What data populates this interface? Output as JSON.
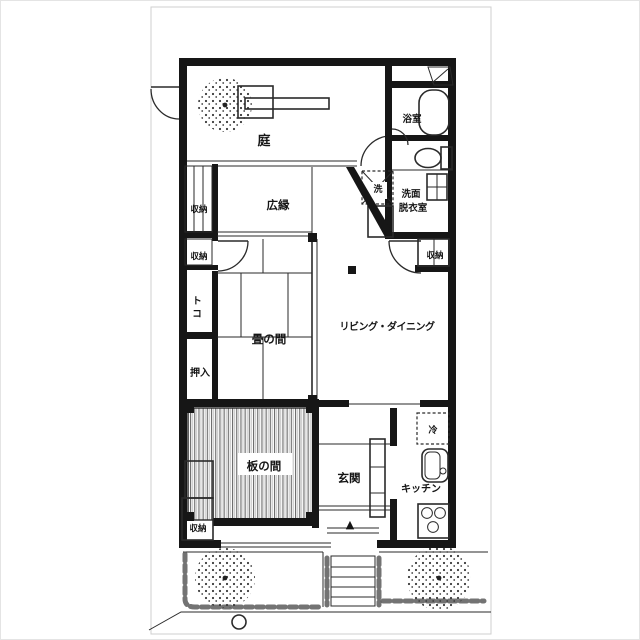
{
  "page": {
    "background": "#ffffff",
    "ink_color": "#161616",
    "scan_border_color": "#cccccc",
    "description": "Japanese apartment floor plan scan"
  },
  "floor_plan": {
    "rooms": {
      "garden": "庭",
      "bathroom": "浴室",
      "washroom_line1": "洗面",
      "washroom_line2": "脱衣室",
      "washer": "洗",
      "veranda": "広縁",
      "storage_top_left_1": "収納",
      "storage_top_left_2": "収納",
      "storage_right": "収納",
      "storage_bottom_left": "収納",
      "toko_char1": "ト",
      "toko_char2": "コ",
      "tatami_room": "畳の間",
      "living_dining": "リビング・ダイニング",
      "closet": "押入",
      "wood_floor_room": "板の間",
      "entrance": "玄関",
      "kitchen": "キッチン",
      "refrigerator": "冷"
    },
    "markers": {
      "entrance_arrow": "▲"
    }
  }
}
